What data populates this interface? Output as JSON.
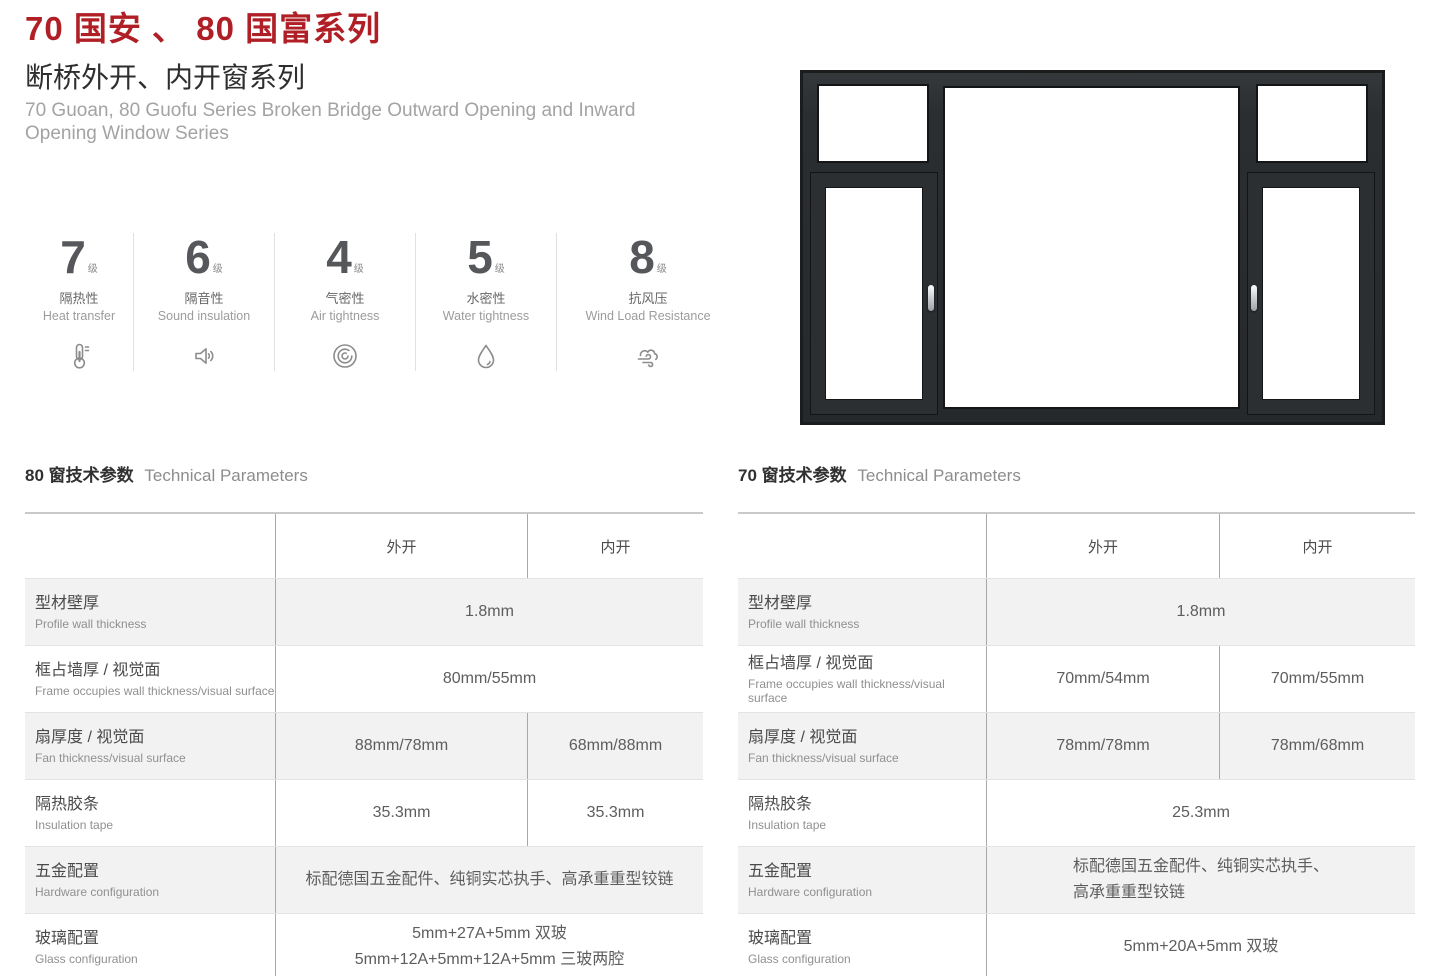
{
  "page": {
    "title": "70 国安 、 80 国富系列",
    "subtitle": "断桥外开、内开窗系列",
    "subtitle_en": "70 Guoan, 80 Guofu Series Broken Bridge Outward Opening and Inward Opening Window Series"
  },
  "colors": {
    "accent_red": "#b01f26",
    "frame_dark": "#2b2e31",
    "row_alt_bg": "#f2f2f3"
  },
  "ratings": [
    {
      "value": "7",
      "unit": "级",
      "label_cn": "隔热性",
      "label_en": "Heat transfer",
      "icon": "thermometer-icon"
    },
    {
      "value": "6",
      "unit": "级",
      "label_cn": "隔音性",
      "label_en": "Sound insulation",
      "icon": "speaker-icon"
    },
    {
      "value": "4",
      "unit": "级",
      "label_cn": "气密性",
      "label_en": "Air tightness",
      "icon": "spiral-icon"
    },
    {
      "value": "5",
      "unit": "级",
      "label_cn": "水密性",
      "label_en": "Water tightness",
      "icon": "droplet-icon"
    },
    {
      "value": "8",
      "unit": "级",
      "label_cn": "抗风压",
      "label_en": "Wind Load Resistance",
      "icon": "wind-icon"
    }
  ],
  "tables": [
    {
      "title_cn": "80 窗技术参数",
      "title_en": "Technical Parameters",
      "col_out": "外开",
      "col_in": "内开",
      "rows": [
        {
          "label_cn": "型材壁厚",
          "label_en": "Profile wall thickness",
          "value": "1.8mm"
        },
        {
          "label_cn": "框占墙厚 / 视觉面",
          "label_en": "Frame occupies wall thickness/visual surface",
          "value": "80mm/55mm"
        },
        {
          "label_cn": "扇厚度 / 视觉面",
          "label_en": "Fan thickness/visual surface",
          "value_out": "88mm/78mm",
          "value_in": "68mm/88mm"
        },
        {
          "label_cn": "隔热胶条",
          "label_en": "Insulation tape",
          "value_out": "35.3mm",
          "value_in": "35.3mm"
        },
        {
          "label_cn": "五金配置",
          "label_en": "Hardware configuration",
          "value": "标配德国五金配件、纯铜实芯执手、高承重重型铰链"
        },
        {
          "label_cn": "玻璃配置",
          "label_en": "Glass configuration",
          "value": "5mm+27A+5mm 双玻\n5mm+12A+5mm+12A+5mm 三玻两腔"
        }
      ]
    },
    {
      "title_cn": "70 窗技术参数",
      "title_en": "Technical Parameters",
      "col_out": "外开",
      "col_in": "内开",
      "rows": [
        {
          "label_cn": "型材壁厚",
          "label_en": "Profile wall thickness",
          "value": "1.8mm"
        },
        {
          "label_cn": "框占墙厚 / 视觉面",
          "label_en": "Frame occupies wall thickness/visual surface",
          "value_out": "70mm/54mm",
          "value_in": "70mm/55mm"
        },
        {
          "label_cn": "扇厚度 / 视觉面",
          "label_en": "Fan thickness/visual surface",
          "value_out": "78mm/78mm",
          "value_in": "78mm/68mm"
        },
        {
          "label_cn": "隔热胶条",
          "label_en": "Insulation tape",
          "value": "25.3mm"
        },
        {
          "label_cn": "五金配置",
          "label_en": "Hardware configuration",
          "value": "标配德国五金配件、纯铜实芯执手、\n高承重重型铰链"
        },
        {
          "label_cn": "玻璃配置",
          "label_en": "Glass configuration",
          "value": "5mm+20A+5mm 双玻"
        }
      ]
    }
  ]
}
